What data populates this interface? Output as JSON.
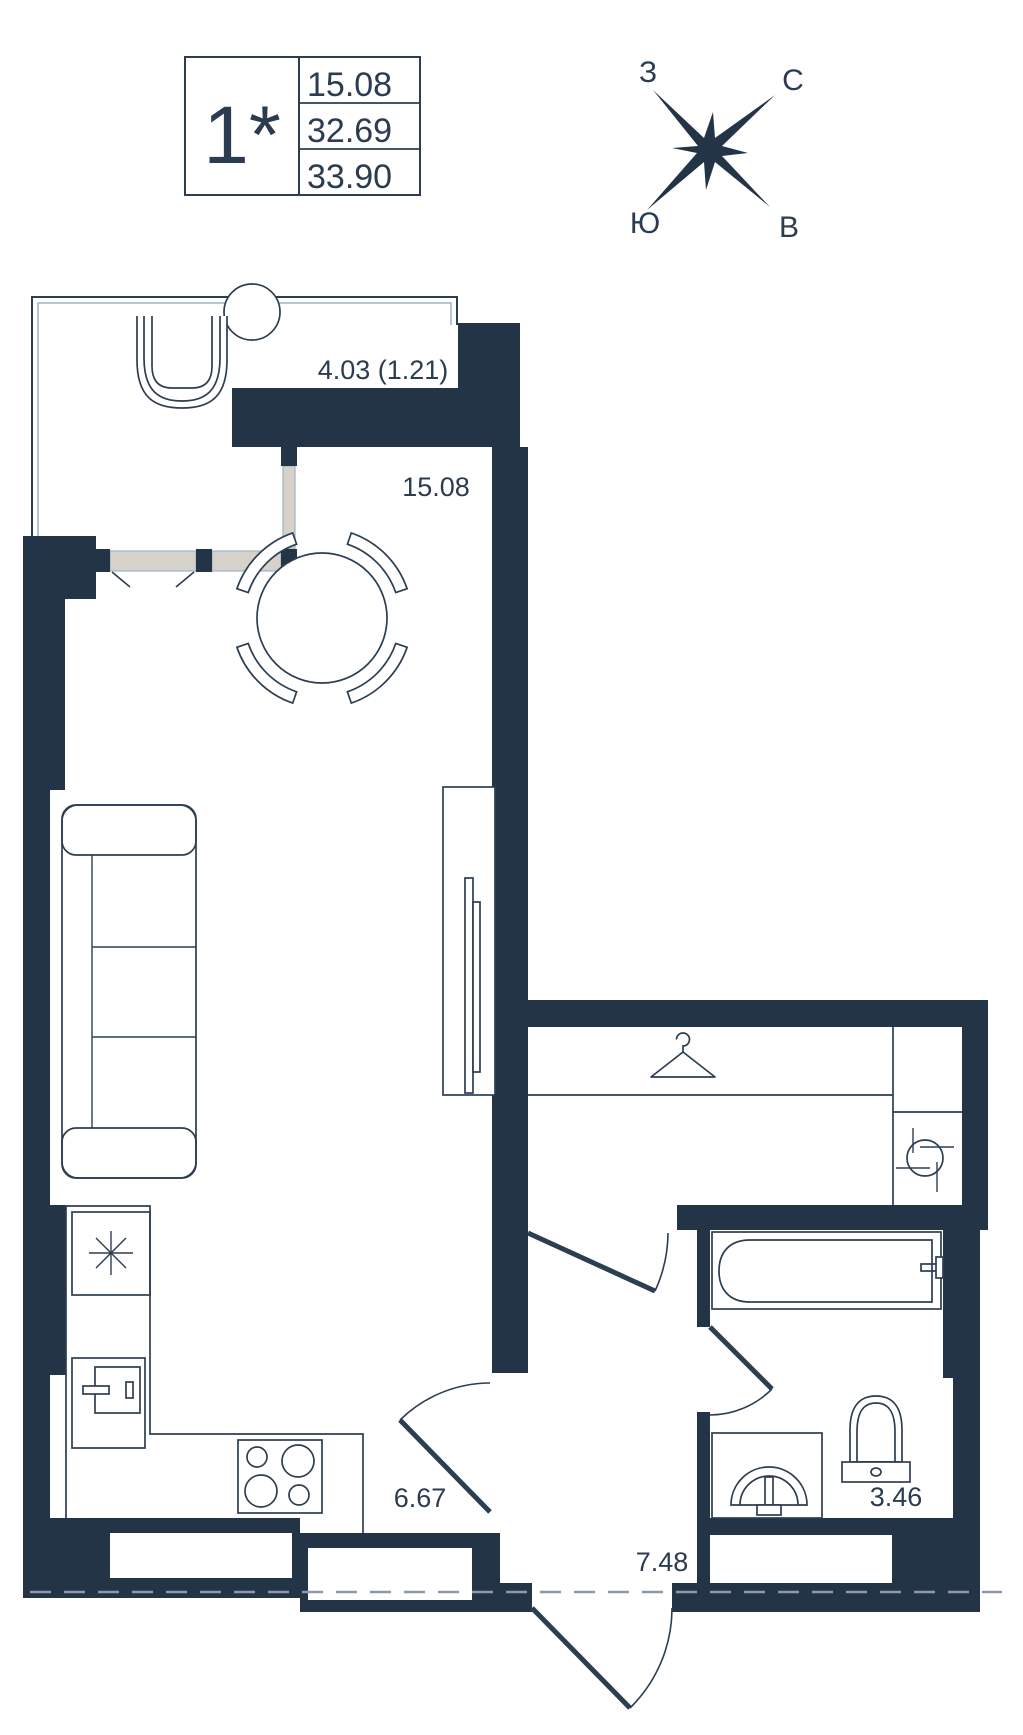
{
  "floorplan": {
    "info_table": {
      "rooms_label": "1*",
      "area_rows": [
        "15.08",
        "32.69",
        "33.90"
      ]
    },
    "compass": {
      "nw": "З",
      "ne": "С",
      "sw": "Ю",
      "se": "В"
    },
    "labels": {
      "balcony": "4.03 (1.21)",
      "room": "15.08",
      "kitchen": "6.67",
      "hall": "7.48",
      "bathroom": "3.46"
    },
    "colors": {
      "wall": "#243447",
      "stroke": "#2c3e52",
      "text": "#2b3c50",
      "window_fill": "#d6d2ca",
      "window_line": "#9db3c9",
      "section_dash": "#8d99a6"
    }
  }
}
